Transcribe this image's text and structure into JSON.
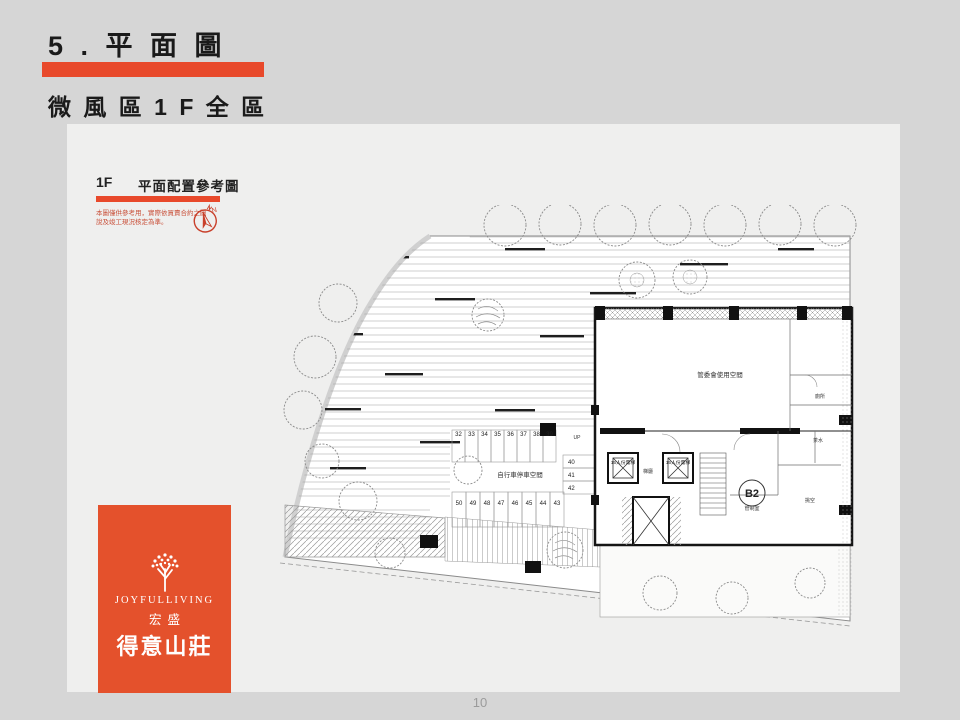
{
  "slide": {
    "title": "5 . 平 面 圖",
    "subtitle": "微 風 區 1 F 全 區",
    "page_number": "10"
  },
  "panel": {
    "floor_tag": "1F",
    "header_title": "平面配置參考圖",
    "disclaimer_line1": "本圖僅供參考用，實際依買賣合約之圖",
    "disclaimer_line2": "說及竣工現況核定為準。",
    "compass_label": "N"
  },
  "plan": {
    "main_room_label": "管委會使用空間",
    "bike_area_label": "自行車停車空間",
    "b2_label": "B2",
    "control_room_label": "管制室",
    "lobby_label": "梯廳",
    "void_label": "挑空",
    "toilet_label": "廁所",
    "pantry_label": "茶水",
    "up_label": "UP",
    "elevator_label": "15人份電梯",
    "parking_top": [
      "32",
      "33",
      "34",
      "35",
      "36",
      "37",
      "38",
      "39"
    ],
    "parking_side": [
      "40",
      "41",
      "42"
    ],
    "parking_bottom": [
      "50",
      "49",
      "48",
      "47",
      "46",
      "45",
      "44",
      "43"
    ]
  },
  "logo": {
    "brand_en": "JOYFULLIVING",
    "company": "宏盛",
    "project": "得意山莊"
  },
  "colors": {
    "accent": "#E8492B",
    "logo_background": "#E4512C",
    "slide_background": "#D6D6D6",
    "panel_background": "#EFEFEE",
    "disclaimer_text": "#C9503A"
  }
}
